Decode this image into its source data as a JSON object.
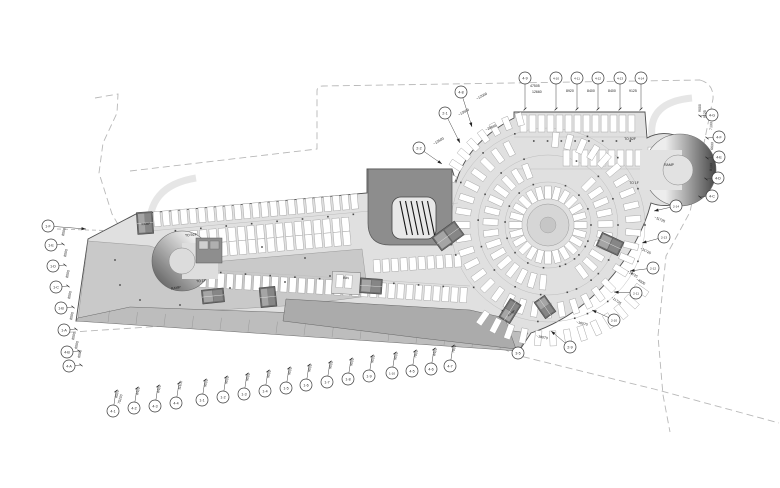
{
  "drawing": {
    "colors": {
      "deck": "#e0e0e0",
      "plaza": "#c9c9c9",
      "band": "#bdbdbd",
      "room": "#ababab",
      "block": "#8d8d8d",
      "core": "#6a6a6a",
      "line": "#4f4f4f",
      "site": "#b8b8b8"
    },
    "labels": [
      {
        "t": "RAMP",
        "x": 146,
        "y": 225,
        "s": 3.0,
        "r": -4,
        "c": "#111111"
      },
      {
        "t": "TO B2F",
        "x": 191,
        "y": 236,
        "s": 3.4,
        "r": -5,
        "c": "#1a1a1a"
      },
      {
        "t": "RAMP",
        "x": 176,
        "y": 289,
        "s": 3.4,
        "r": -10,
        "c": "#2a2a2a"
      },
      {
        "t": "TO 1F",
        "x": 201,
        "y": 282,
        "s": 3.4,
        "r": -5,
        "c": "#1a1a1a"
      },
      {
        "t": "BIN",
        "x": 346,
        "y": 279,
        "s": 3.3,
        "r": 3,
        "c": "#1a1a1a"
      },
      {
        "t": "TO B2F",
        "x": 630,
        "y": 140,
        "s": 3.4,
        "r": 0,
        "c": "#1a1a1a"
      },
      {
        "t": "TO 1F",
        "x": 634,
        "y": 184,
        "s": 3.4,
        "r": 0,
        "c": "#1a1a1a"
      },
      {
        "t": "RAMP",
        "x": 669,
        "y": 166,
        "s": 3.4,
        "r": 0,
        "c": "#f2f2f2"
      },
      {
        "t": "RAMP",
        "x": 512,
        "y": 314,
        "s": 2.9,
        "r": -40,
        "c": "#f0f0f0"
      }
    ],
    "grid_bubbles": [
      {
        "id": "4-9",
        "x": 525,
        "y": 78,
        "lx": 525,
        "ly": 109
      },
      {
        "id": "4-10",
        "x": 556,
        "y": 78,
        "lx": 556,
        "ly": 109
      },
      {
        "id": "4-11",
        "x": 577,
        "y": 78,
        "lx": 577,
        "ly": 109
      },
      {
        "id": "4-12",
        "x": 598,
        "y": 78,
        "lx": 598,
        "ly": 109
      },
      {
        "id": "4-13",
        "x": 620,
        "y": 78,
        "lx": 620,
        "ly": 109
      },
      {
        "id": "4-14",
        "x": 641,
        "y": 78,
        "lx": 641,
        "ly": 109
      },
      {
        "id": "4-8",
        "x": 461,
        "y": 92,
        "lx": 472,
        "ly": 127,
        "arrow": true
      },
      {
        "id": "2-1",
        "x": 445,
        "y": 113,
        "lx": 460,
        "ly": 143,
        "arrow": true
      },
      {
        "id": "2-2",
        "x": 419,
        "y": 148,
        "lx": 442,
        "ly": 164,
        "arrow": true
      },
      {
        "id": "4-G",
        "x": 712,
        "y": 115,
        "lx": 700,
        "ly": 116
      },
      {
        "id": "4-F",
        "x": 719,
        "y": 137,
        "lx": 707,
        "ly": 138
      },
      {
        "id": "4-E",
        "x": 719,
        "y": 157,
        "lx": 707,
        "ly": 158
      },
      {
        "id": "4-D",
        "x": 718,
        "y": 178,
        "lx": 706,
        "ly": 179
      },
      {
        "id": "4-C",
        "x": 712,
        "y": 196,
        "lx": 700,
        "ly": 197
      },
      {
        "id": "2-14",
        "x": 676,
        "y": 206,
        "lx": 654,
        "ly": 211,
        "arrow": true
      },
      {
        "id": "2-13",
        "x": 664,
        "y": 237,
        "lx": 642,
        "ly": 243,
        "arrow": true
      },
      {
        "id": "2-12",
        "x": 653,
        "y": 268,
        "lx": 630,
        "ly": 271,
        "arrow": true
      },
      {
        "id": "2-11",
        "x": 636,
        "y": 293,
        "lx": 614,
        "ly": 292,
        "arrow": true
      },
      {
        "id": "2-10",
        "x": 614,
        "y": 320,
        "lx": 592,
        "ly": 310,
        "arrow": true
      },
      {
        "id": "2-9",
        "x": 570,
        "y": 347,
        "lx": 551,
        "ly": 331,
        "arrow": true
      },
      {
        "id": "3-5",
        "x": 518,
        "y": 353,
        "lx": 519,
        "ly": 349,
        "arrow": true
      },
      {
        "id": "1-F",
        "x": 48,
        "y": 226,
        "lx": 86,
        "ly": 229,
        "arrow": true
      },
      {
        "id": "1-E",
        "x": 51,
        "y": 245,
        "lx": 63,
        "ly": 244
      },
      {
        "id": "1-D",
        "x": 53,
        "y": 266,
        "lx": 65,
        "ly": 265
      },
      {
        "id": "1-C",
        "x": 56,
        "y": 287,
        "lx": 68,
        "ly": 286
      },
      {
        "id": "1-B",
        "x": 61,
        "y": 308,
        "lx": 73,
        "ly": 307
      },
      {
        "id": "1-A",
        "x": 64,
        "y": 330,
        "lx": 76,
        "ly": 329
      },
      {
        "id": "4-B",
        "x": 67,
        "y": 352,
        "lx": 79,
        "ly": 351
      },
      {
        "id": "4-A",
        "x": 69,
        "y": 366,
        "lx": 81,
        "ly": 365
      },
      {
        "id": "4-1",
        "x": 113,
        "y": 411,
        "lx": 116,
        "ly": 391
      },
      {
        "id": "4-2",
        "x": 134,
        "y": 408,
        "lx": 137,
        "ly": 388
      },
      {
        "id": "4-3",
        "x": 155,
        "y": 406,
        "lx": 158,
        "ly": 386
      },
      {
        "id": "4-4",
        "x": 176,
        "y": 403,
        "lx": 179,
        "ly": 383
      },
      {
        "id": "1-1",
        "x": 202,
        "y": 400,
        "lx": 205,
        "ly": 380
      },
      {
        "id": "1-2",
        "x": 223,
        "y": 397,
        "lx": 226,
        "ly": 377
      },
      {
        "id": "1-3",
        "x": 244,
        "y": 394,
        "lx": 247,
        "ly": 374
      },
      {
        "id": "1-4",
        "x": 265,
        "y": 391,
        "lx": 268,
        "ly": 371
      },
      {
        "id": "1-5",
        "x": 286,
        "y": 388,
        "lx": 289,
        "ly": 368
      },
      {
        "id": "1-6",
        "x": 306,
        "y": 385,
        "lx": 309,
        "ly": 365
      },
      {
        "id": "1-7",
        "x": 327,
        "y": 382,
        "lx": 330,
        "ly": 362
      },
      {
        "id": "1-8",
        "x": 348,
        "y": 379,
        "lx": 351,
        "ly": 359
      },
      {
        "id": "1-9",
        "x": 369,
        "y": 376,
        "lx": 372,
        "ly": 356
      },
      {
        "id": "1-10",
        "x": 392,
        "y": 373,
        "lx": 395,
        "ly": 353
      },
      {
        "id": "4-5",
        "x": 412,
        "y": 371,
        "lx": 415,
        "ly": 351
      },
      {
        "id": "4-6",
        "x": 431,
        "y": 369,
        "lx": 434,
        "ly": 349
      },
      {
        "id": "4-7",
        "x": 450,
        "y": 366,
        "lx": 453,
        "ly": 346
      }
    ],
    "dimensions": [
      {
        "t": "47505",
        "x": 530,
        "y": 87,
        "r": 0
      },
      {
        "t": "12660",
        "x": 532,
        "y": 93,
        "r": 0
      },
      {
        "t": "8920",
        "x": 566,
        "y": 92,
        "r": 0
      },
      {
        "t": "8400",
        "x": 587,
        "y": 92,
        "r": 0
      },
      {
        "t": "8400",
        "x": 608,
        "y": 92,
        "r": 0
      },
      {
        "t": "9125",
        "x": 629,
        "y": 92,
        "r": 0
      },
      {
        "t": "~12000",
        "x": 477,
        "y": 100,
        "r": 28
      },
      {
        "t": "~13500",
        "x": 459,
        "y": 116,
        "r": 28
      },
      {
        "t": "~13500",
        "x": 434,
        "y": 145,
        "r": 30
      },
      {
        "t": "~20865",
        "x": 486,
        "y": 131,
        "r": 24
      },
      {
        "t": "9000",
        "x": 701,
        "y": 112,
        "r": 90
      },
      {
        "t": "9125",
        "x": 706,
        "y": 118,
        "r": 90
      },
      {
        "t": "7100",
        "x": 712,
        "y": 130,
        "r": 87
      },
      {
        "t": "6600",
        "x": 713,
        "y": 150,
        "r": 87
      },
      {
        "t": "8100",
        "x": 712,
        "y": 171,
        "r": 87
      },
      {
        "t": "~11725",
        "x": 654,
        "y": 218,
        "r": -24
      },
      {
        "t": "~11725",
        "x": 640,
        "y": 249,
        "r": -28
      },
      {
        "t": "~11725",
        "x": 627,
        "y": 272,
        "r": -31
      },
      {
        "t": "~4000",
        "x": 636,
        "y": 280,
        "r": -31
      },
      {
        "t": "~11725",
        "x": 611,
        "y": 298,
        "r": -36
      },
      {
        "t": "~16570",
        "x": 576,
        "y": 323,
        "r": -14
      },
      {
        "t": "~18070",
        "x": 536,
        "y": 337,
        "r": -12
      },
      {
        "t": "8000",
        "x": 64,
        "y": 236,
        "r": 78
      },
      {
        "t": "8000",
        "x": 66,
        "y": 257,
        "r": 78
      },
      {
        "t": "8000",
        "x": 68,
        "y": 278,
        "r": 78
      },
      {
        "t": "8000",
        "x": 70,
        "y": 299,
        "r": 78
      },
      {
        "t": "8000",
        "x": 72,
        "y": 320,
        "r": 78
      },
      {
        "t": "8000",
        "x": 74,
        "y": 340,
        "r": 78
      },
      {
        "t": "6000",
        "x": 77,
        "y": 349,
        "r": 78
      },
      {
        "t": "6000",
        "x": 80,
        "y": 358,
        "r": 78
      },
      {
        "t": "8500",
        "x": 117,
        "y": 398,
        "r": 75
      },
      {
        "t": "75200",
        "x": 120,
        "y": 404,
        "r": 75
      },
      {
        "t": "8400",
        "x": 138,
        "y": 395,
        "r": 75
      },
      {
        "t": "8400",
        "x": 159,
        "y": 393,
        "r": 75
      },
      {
        "t": "11100",
        "x": 180,
        "y": 390,
        "r": 75
      },
      {
        "t": "9000",
        "x": 206,
        "y": 387,
        "r": 75
      },
      {
        "t": "9000",
        "x": 227,
        "y": 384,
        "r": 75
      },
      {
        "t": "9000",
        "x": 248,
        "y": 381,
        "r": 75
      },
      {
        "t": "9000",
        "x": 269,
        "y": 378,
        "r": 75
      },
      {
        "t": "9000",
        "x": 290,
        "y": 375,
        "r": 75
      },
      {
        "t": "9000",
        "x": 310,
        "y": 372,
        "r": 75
      },
      {
        "t": "9000",
        "x": 331,
        "y": 369,
        "r": 75
      },
      {
        "t": "9000",
        "x": 352,
        "y": 366,
        "r": 75
      },
      {
        "t": "9000",
        "x": 373,
        "y": 363,
        "r": 75
      },
      {
        "t": "9000",
        "x": 396,
        "y": 360,
        "r": 75
      },
      {
        "t": "7800",
        "x": 416,
        "y": 358,
        "r": 75
      },
      {
        "t": "8400",
        "x": 435,
        "y": 356,
        "r": 75
      },
      {
        "t": "7800",
        "x": 454,
        "y": 353,
        "r": 75
      }
    ]
  }
}
